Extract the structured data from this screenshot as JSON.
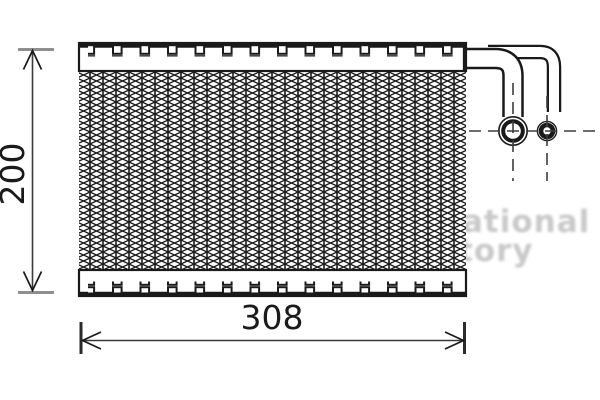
{
  "dimensions": {
    "height": "200",
    "width": "308"
  },
  "watermark": {
    "line1": "ational",
    "line2": "tory"
  },
  "colors": {
    "line": "#1a1a1a",
    "dim_line": "#3a3a3a",
    "tick_gray": "#8f8f8f",
    "tick_dark": "#2b2b2b",
    "watermark": "#c9c9c9"
  }
}
